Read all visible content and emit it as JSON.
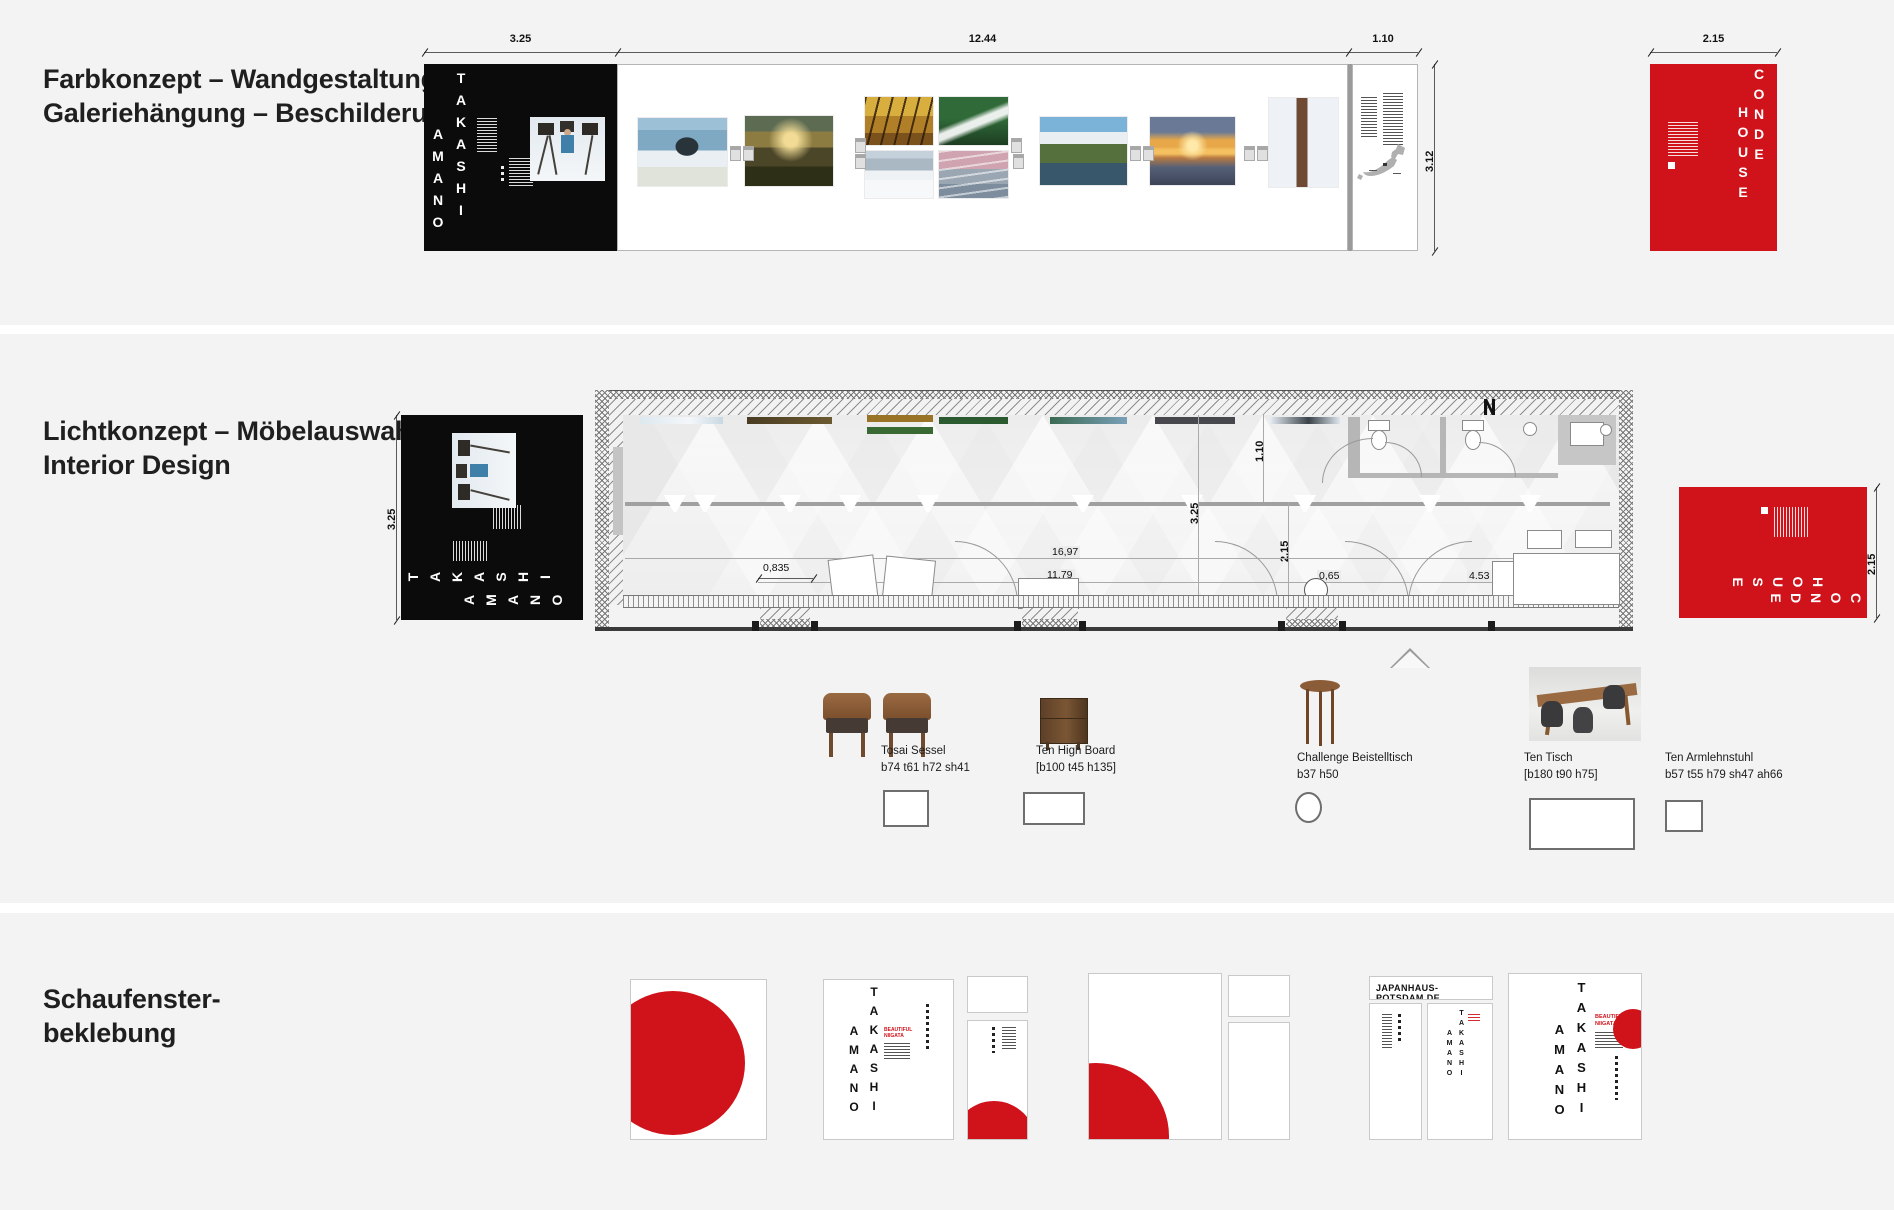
{
  "sec1": {
    "title1": "Farbkonzept – Wandgestaltung –",
    "title2": "Galeriehängung – Beschilderung",
    "dim_poster_w": "3.25",
    "dim_gallery_w": "12.44",
    "dim_info_w": "1.10",
    "dim_wall_h": "3.12",
    "dim_conde_w": "2.15"
  },
  "sec2": {
    "title1": "Lichtkonzept – Möbelauswahl",
    "title2": "Interior Design",
    "dim_poster_h": "3.25",
    "dim_conde_h": "2.15",
    "plan_dims": {
      "d110": "1.10",
      "d325": "3.25",
      "d215": "2.15",
      "d0835": "0,835",
      "d1697": "16,97",
      "d1179": "11,79",
      "d065": "0,65",
      "d453": "4.53"
    },
    "furniture": [
      {
        "name": "Tosai Sessel",
        "spec": "b74 t61 h72 sh41"
      },
      {
        "name": "Ten High Board",
        "spec": "[b100 t45 h135]"
      },
      {
        "name": "Challenge Beistelltisch",
        "spec": "b37 h50"
      },
      {
        "name": "Ten Tisch",
        "spec": "[b180 t90 h75]"
      },
      {
        "name": "Ten Armlehnstuhl",
        "spec": "b57 t55 h79 sh47 ah66"
      }
    ]
  },
  "sec3": {
    "title1": "Schaufenster-",
    "title2": "beklebung",
    "website": "JAPANHAUS-POTSDAM.DE"
  },
  "poster": {
    "takashi": "TAKASHI",
    "amano": "AMANO",
    "beautiful": "BEAUTIFUL",
    "niigata": "NIIGATA"
  },
  "conde": {
    "word1": "CONDE",
    "word2": "HOUSE"
  },
  "colors": {
    "red": "#d0121a",
    "black": "#0b0b0b",
    "panel_bg": "#f3f3f3"
  }
}
